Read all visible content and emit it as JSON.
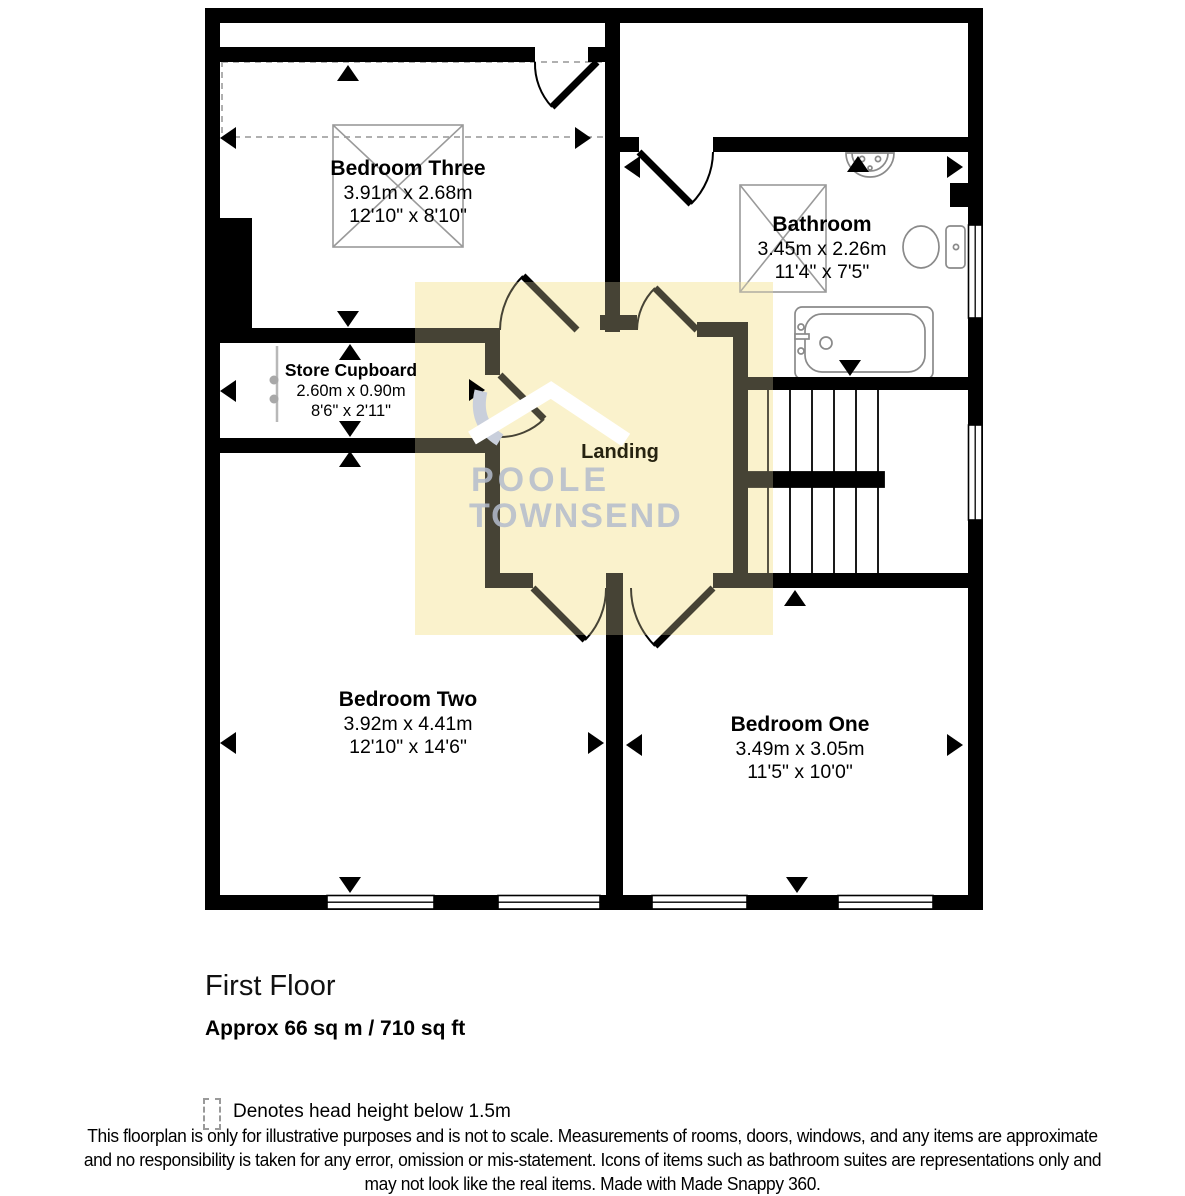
{
  "floorplan": {
    "rooms": [
      {
        "name": "Bedroom Three",
        "metric": "3.91m x 2.68m",
        "imperial": "12'10\" x 8'10\""
      },
      {
        "name": "Bathroom",
        "metric": "3.45m x 2.26m",
        "imperial": "11'4\" x 7'5\""
      },
      {
        "name": "Store Cupboard",
        "metric": "2.60m x 0.90m",
        "imperial": "8'6\" x 2'11\""
      },
      {
        "name": "Landing",
        "metric": "",
        "imperial": ""
      },
      {
        "name": "Bedroom Two",
        "metric": "3.92m x 4.41m",
        "imperial": "12'10\" x 14'6\""
      },
      {
        "name": "Bedroom One",
        "metric": "3.49m x 3.05m",
        "imperial": "11'5\" x 10'0\""
      }
    ],
    "watermark": {
      "line1": "POOLE",
      "line2": "TOWNSEND"
    },
    "title": "First Floor",
    "area": "Approx 66 sq m / 710 sq ft",
    "legend": "Denotes head height below 1.5m",
    "disclaimer_lines": [
      "This floorplan is only for illustrative purposes and is not to scale. Measurements of rooms, doors, windows, and any items are approximate",
      "and no responsibility is taken for any error, omission or mis-statement. Icons of items such as bathroom suites are representations only and",
      "may not look like the real items. Made with Made Snappy 360."
    ],
    "icons": {
      "measure-arrow": "black triangle measurement marker",
      "head-height-legend": "dashed rectangle",
      "brand-logo": "roof chevron"
    },
    "colors": {
      "wall": "#000000",
      "landing_highlight": "#faf3d1",
      "watermark": "#b4bccd",
      "fixture_outline": "#8a8a8a",
      "dashed_region": "#b0b0b0"
    }
  }
}
